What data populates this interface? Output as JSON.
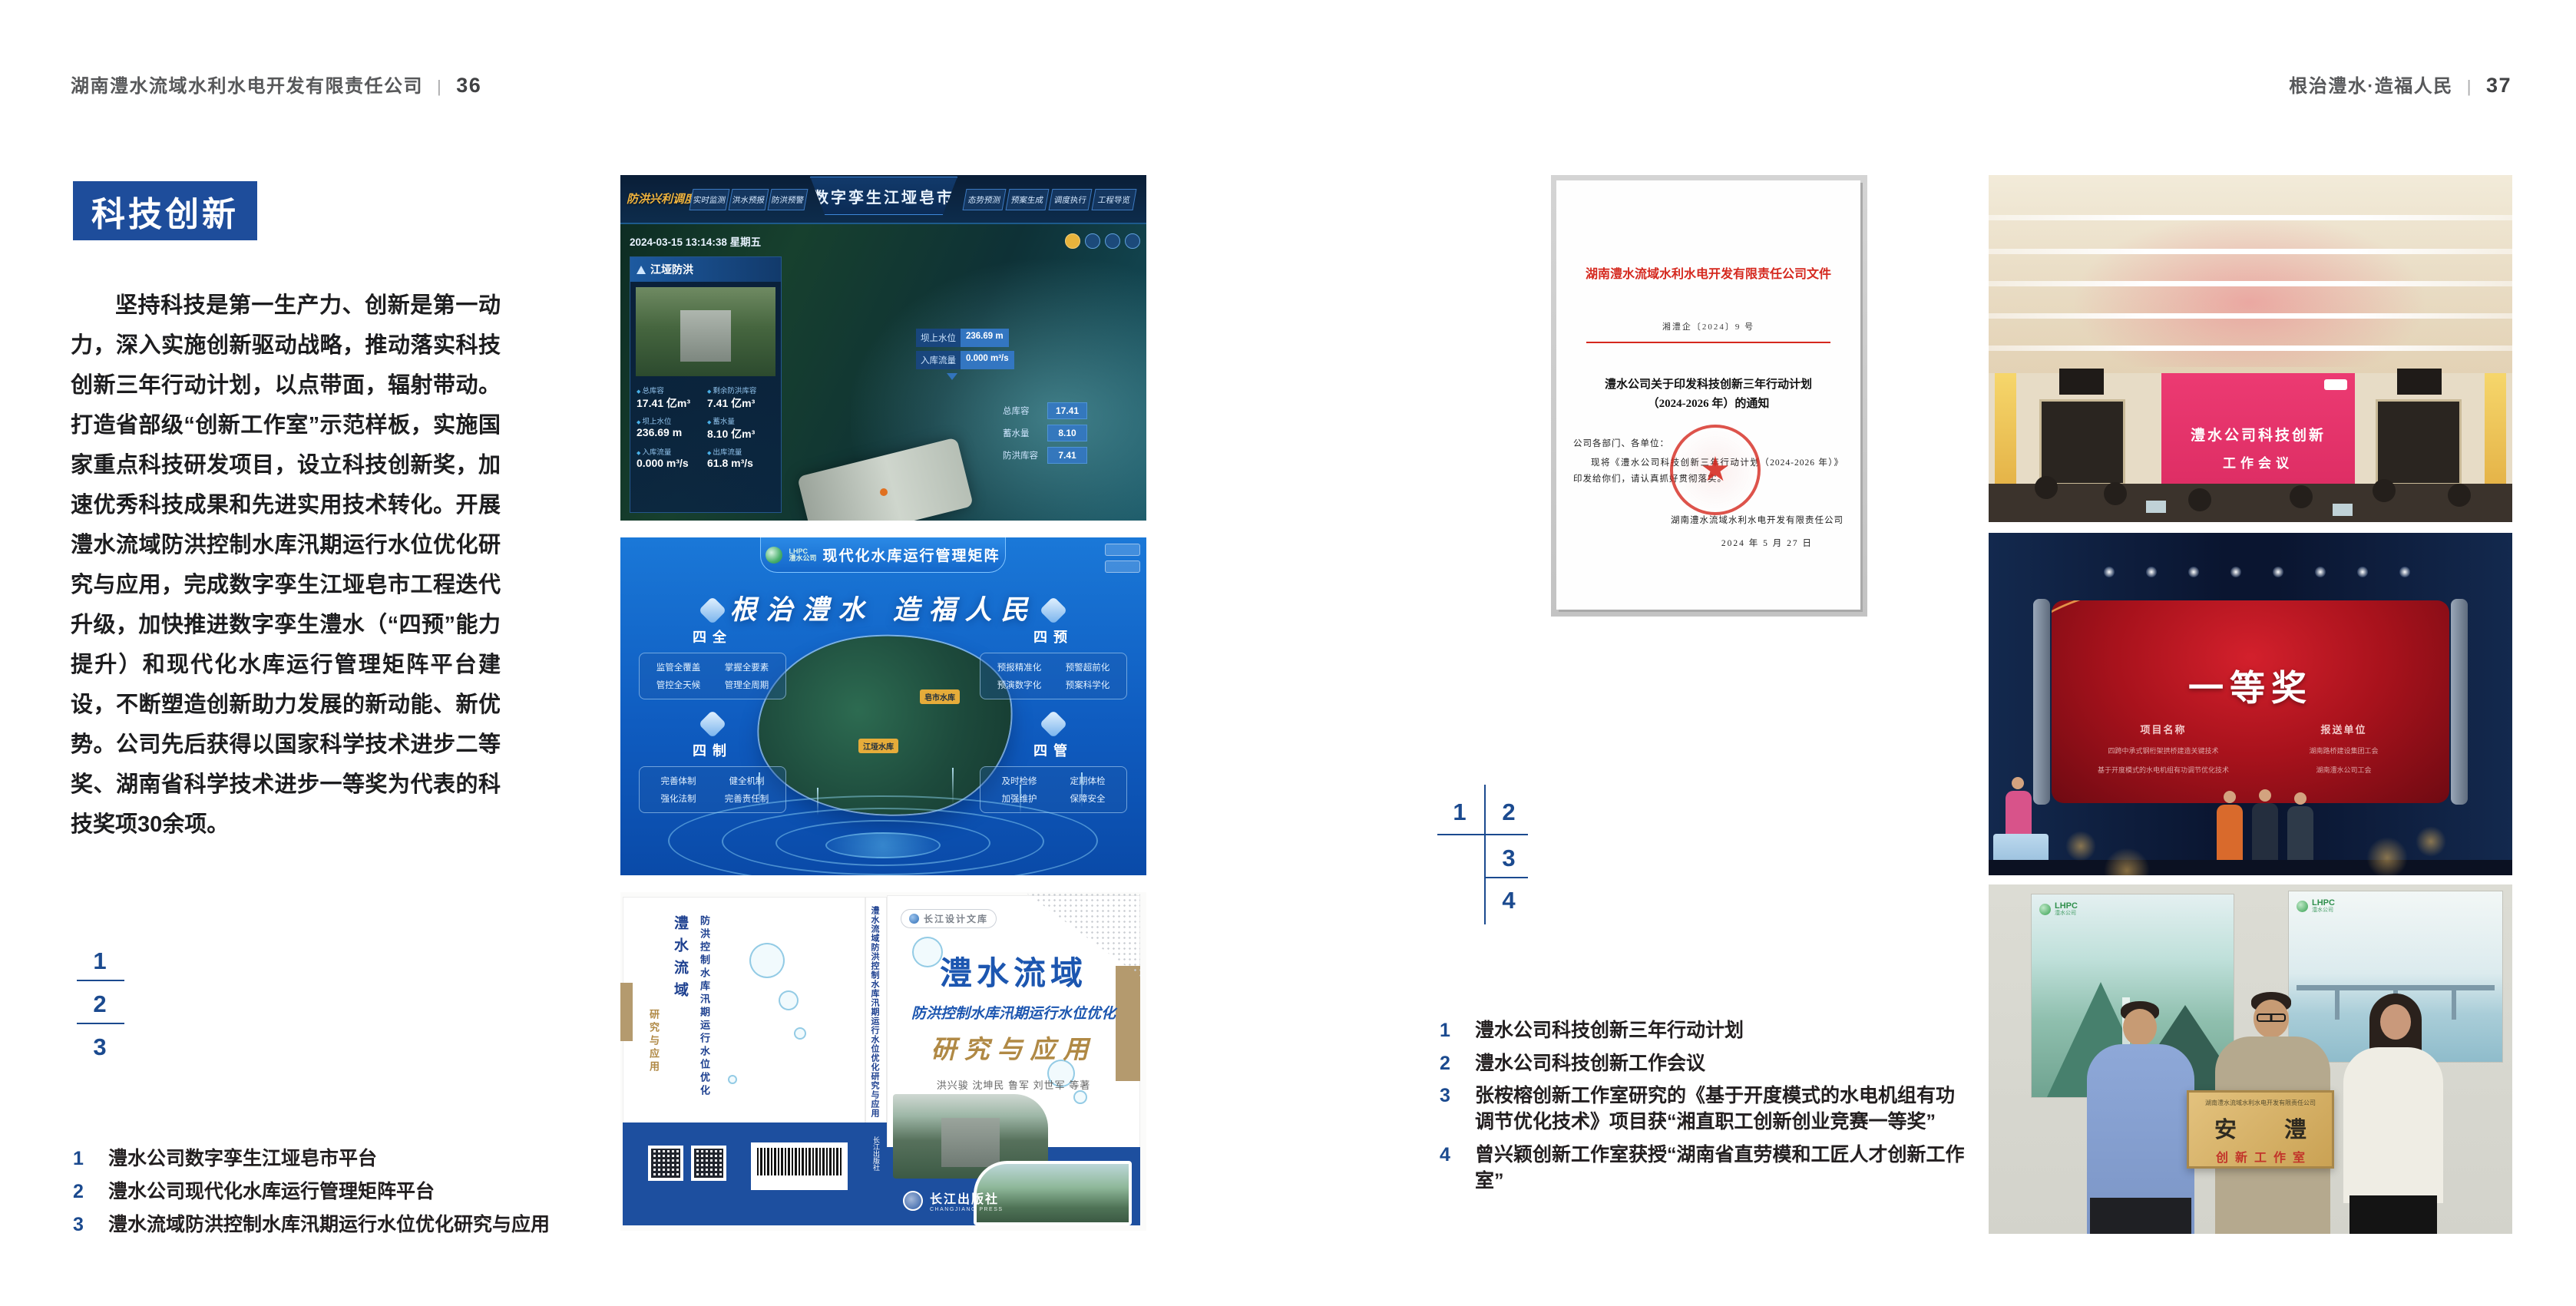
{
  "colors": {
    "accent_blue": "#1e4d9b",
    "index_blue": "#1b4a8f",
    "doc_red": "#d5281e",
    "band_blue": "#1d4f9f",
    "text_dark": "#231f20",
    "header_gray": "#58595a"
  },
  "left": {
    "header": {
      "company": "湖南澧水流域水利水电开发有限责任公司",
      "sep": "|",
      "page": "36"
    },
    "section_title": "科技创新",
    "paragraph": "坚持科技是第一生产力、创新是第一动力，深入实施创新驱动战略，推动落实科技创新三年行动计划，以点带面，辐射带动。打造省部级“创新工作室”示范样板，实施国家重点科技研发项目，设立科技创新奖，加速优秀科技成果和先进实用技术转化。开展澧水流域防洪控制水库汛期运行水位优化研究与应用，完成数字孪生江垭皂市工程迭代升级，加快推进数字孪生澧水（“四预”能力提升）和现代化水库运行管理矩阵平台建设，不断塑造创新助力发展的新动能、新优势。公司先后获得以国家科学技术进步二等奖、湖南省科学技术进步一等奖为代表的科技奖项30余项。",
    "index": [
      "1",
      "2",
      "3"
    ],
    "captions": [
      {
        "num": "1",
        "text": "澧水公司数字孪生江垭皂市平台"
      },
      {
        "num": "2",
        "text": "澧水公司现代化水库运行管理矩阵平台"
      },
      {
        "num": "3",
        "text": "澧水流域防洪控制水库汛期运行水位优化研究与应用"
      }
    ],
    "dashboard": {
      "badge": "防洪兴利调度",
      "tabs_left": [
        "实时监测",
        "洪水预报",
        "防洪预警"
      ],
      "title": "数字孪生江垭皂市",
      "tabs_right": [
        "态势预测",
        "预案生成",
        "调度执行",
        "工程导览"
      ],
      "datetime": "2024-03-15 13:14:38 星期五",
      "panel_title": "江垭防洪",
      "stats": [
        {
          "label": "总库容",
          "value": "17.41 亿m³"
        },
        {
          "label": "剩余防洪库容",
          "value": "7.41 亿m³"
        },
        {
          "label": "坝上水位",
          "value": "236.69 m"
        },
        {
          "label": "蓄水量",
          "value": "8.10 亿m³"
        },
        {
          "label": "入库流量",
          "value": "0.000 m³/s"
        },
        {
          "label": "出库流量",
          "value": "61.8 m³/s"
        }
      ],
      "tags": [
        {
          "label": "坝上水位",
          "value": "236.69 m"
        },
        {
          "label": "入库流量",
          "value": "0.000 m³/s"
        }
      ],
      "side_stats": [
        {
          "label": "总库容",
          "value": "17.41"
        },
        {
          "label": "蓄水量",
          "value": "8.10"
        },
        {
          "label": "防洪库容",
          "value": "7.41"
        }
      ]
    },
    "matrix": {
      "logo": "LHPC",
      "logo_sub": "澧水公司",
      "title": "现代化水库运行管理矩阵",
      "slogan": "根治澧水 造福人民",
      "groups": [
        {
          "name": "四全",
          "items": [
            "监管全覆盖",
            "掌握全要素",
            "管控全天候",
            "管理全周期"
          ]
        },
        {
          "name": "四预",
          "items": [
            "预报精准化",
            "预警超前化",
            "预演数字化",
            "预案科学化"
          ]
        },
        {
          "name": "四制",
          "items": [
            "完善体制",
            "健全机制",
            "强化法制",
            "完善责任制"
          ]
        },
        {
          "name": "四管",
          "items": [
            "及时检修",
            "定期体检",
            "加强维护",
            "保障安全"
          ]
        }
      ],
      "markers": [
        "皂市水库",
        "江垭水库"
      ]
    },
    "book": {
      "series": "长江设计文库",
      "title1": "澧水流域",
      "title2": "防洪控制水库汛期运行水位优化",
      "title3": "研究与应用",
      "authors": "洪兴骏 沈坤民 鲁军 刘世军 等著",
      "publisher": "长江出版社",
      "publisher_en": "CHANGJIANG PRESS",
      "spine_title": "澧水流域防洪控制水库汛期运行水位优化研究与应用",
      "back_title1": "澧水流域",
      "back_title2": "防洪控制水库汛期运行水位优化",
      "back_title3": "研究与应用"
    }
  },
  "right": {
    "header": {
      "motto": "根治澧水·造福人民",
      "sep": "|",
      "page": "37"
    },
    "document": {
      "org_header": "湖南澧水流域水利水电开发有限责任公司文件",
      "doc_no": "湘澧企〔2024〕9 号",
      "title_line1": "澧水公司关于印发科技创新三年行动计划",
      "title_line2": "（2024-2026 年）的通知",
      "salutation": "公司各部门、各单位：",
      "body": "现将《澧水公司科技创新三年行动计划（2024-2026 年）》印发给你们，请认真抓好贯彻落实。",
      "signer": "湖南澧水流域水利水电开发有限责任公司",
      "date": "2024 年 5 月 27 日"
    },
    "index": [
      "1",
      "2",
      "3",
      "4"
    ],
    "captions": [
      {
        "num": "1",
        "text": "澧水公司科技创新三年行动计划"
      },
      {
        "num": "2",
        "text": "澧水公司科技创新工作会议"
      },
      {
        "num": "3",
        "text": "张桉榕创新工作室研究的《基于开度模式的水电机组有功调节优化技术》项目获“湘直职工创新创业竞赛一等奖”"
      },
      {
        "num": "4",
        "text": "曾兴颖创新工作室获授“湖南省直劳模和工匠人才创新工作室”"
      }
    ],
    "meeting": {
      "screen_line1": "澧水公司科技创新",
      "screen_line2": "工作会议"
    },
    "award": {
      "title": "一等奖",
      "col_project": "项目名称",
      "col_unit": "报送单位",
      "projects": [
        "四跨中承式钢桁架拱桥建造关键技术",
        "基于开度模式的水电机组有功调节优化技术"
      ],
      "units": [
        "湖南路桥建设集团工会",
        "湖南澧水公司工会"
      ]
    },
    "group": {
      "poster_logo": "LHPC",
      "poster_logo_sub": "澧水公司",
      "plaque_org": "湖南澧水流域水利水电开发有限责任公司",
      "plaque_main": "安 澧",
      "plaque_sub": "创新工作室"
    }
  }
}
